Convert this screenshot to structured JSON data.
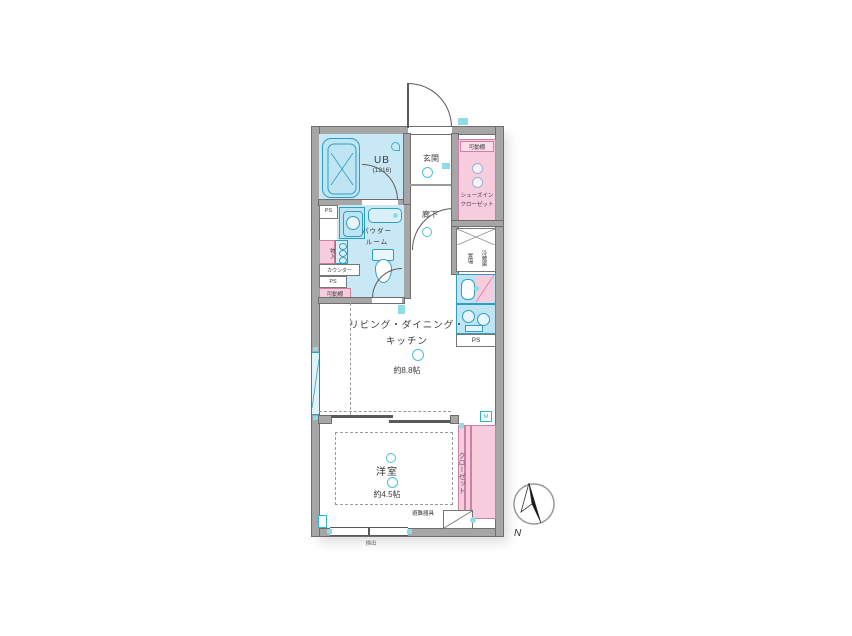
{
  "floorplan": {
    "rooms": {
      "unit_bath": {
        "name": "UB",
        "size": "(1216)"
      },
      "entrance": {
        "name": "玄関"
      },
      "hallway": {
        "name": "廊下"
      },
      "shoes_closet": {
        "line1": "シューズイン",
        "line2": "クローゼット"
      },
      "powder_room": {
        "line1": "パウダー",
        "line2": "ルーム"
      },
      "ldk": {
        "line1": "リビング・ダイニング・",
        "line2": "キッチン",
        "size": "約8.8帖"
      },
      "western_room": {
        "name": "洋室",
        "size": "約4.5帖"
      },
      "closet": {
        "name": "クローゼット"
      }
    },
    "labels": {
      "movable_shelf": "可動棚",
      "pipe_space": "PS",
      "counter": "カウンター",
      "storage": "物入",
      "refrigerator_line1": "冷蔵庫",
      "refrigerator_line2": "置場",
      "escape_equipment": "避難器具",
      "sweep_window": "掃出",
      "meter": "M"
    },
    "compass": {
      "north": "N"
    },
    "colors": {
      "wall": "#a6a6a6",
      "water_area": "#c9e8f5",
      "fixture_line": "#2e9fc4",
      "closet_pink": "#f7cddd",
      "pink_line": "#cd7fa4",
      "symbol_teal": "#2fb6c9"
    }
  }
}
